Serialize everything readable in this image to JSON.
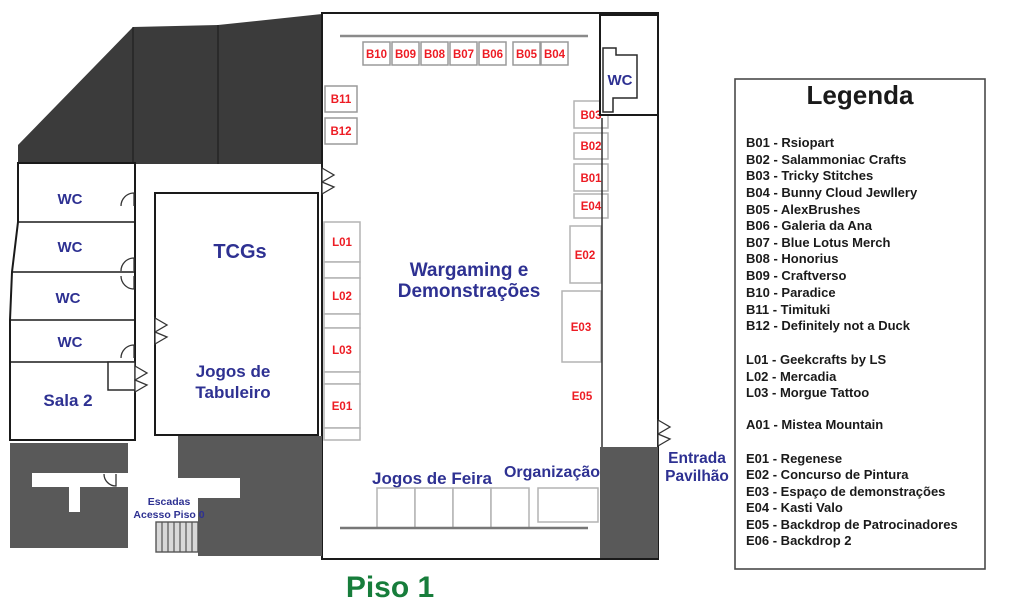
{
  "floor_title": "Piso 1",
  "colors": {
    "wall_dark": "#3b3b3b",
    "block_gray": "#595959",
    "label_navy": "#2e3192",
    "booth_red": "#ed1c24",
    "title_green": "#177d3b"
  },
  "rooms": {
    "wc": "WC",
    "sala2": "Sala 2",
    "tcgs": "TCGs",
    "tabuleiro_l1": "Jogos de",
    "tabuleiro_l2": "Tabuleiro",
    "wargaming_l1": "Wargaming e",
    "wargaming_l2": "Demonstrações",
    "feira": "Jogos de Feira",
    "organizacao": "Organização",
    "entrada_l1": "Entrada",
    "entrada_l2": "Pavilhão",
    "escadas_l1": "Escadas",
    "escadas_l2": "Acesso Piso 0"
  },
  "booths": {
    "top_row": [
      "B10",
      "B09",
      "B08",
      "B07",
      "B06",
      "B05",
      "B04"
    ],
    "left_wall": [
      "B11",
      "B12"
    ],
    "l_column": [
      "L01",
      "L02",
      "L03",
      "E01"
    ],
    "right_column": [
      "B03",
      "B02",
      "B01",
      "E04"
    ],
    "areas": [
      "E02",
      "E03",
      "E05"
    ]
  },
  "legend": {
    "title": "Legenda",
    "b_items": [
      "B01 - Rsiopart",
      "B02 - Salammoniac Crafts",
      "B03 - Tricky Stitches",
      "B04 - Bunny Cloud Jewllery",
      "B05 - AlexBrushes",
      "B06 - Galeria da Ana",
      "B07 - Blue Lotus Merch",
      "B08 - Honorius",
      "B09 - Craftverso",
      "B10 - Paradice",
      "B11 - Timituki",
      "B12 - Definitely not a Duck"
    ],
    "l_items": [
      "L01 - Geekcrafts by LS",
      "L02 - Mercadia",
      "L03 - Morgue Tattoo"
    ],
    "a_items": [
      "A01 - Mistea Mountain"
    ],
    "e_items": [
      "E01 - Regenese",
      "E02 - Concurso de Pintura",
      "E03 - Espaço de demonstrações",
      "E04 - Kasti Valo",
      "E05 - Backdrop de Patrocinadores",
      "E06 - Backdrop 2"
    ]
  }
}
